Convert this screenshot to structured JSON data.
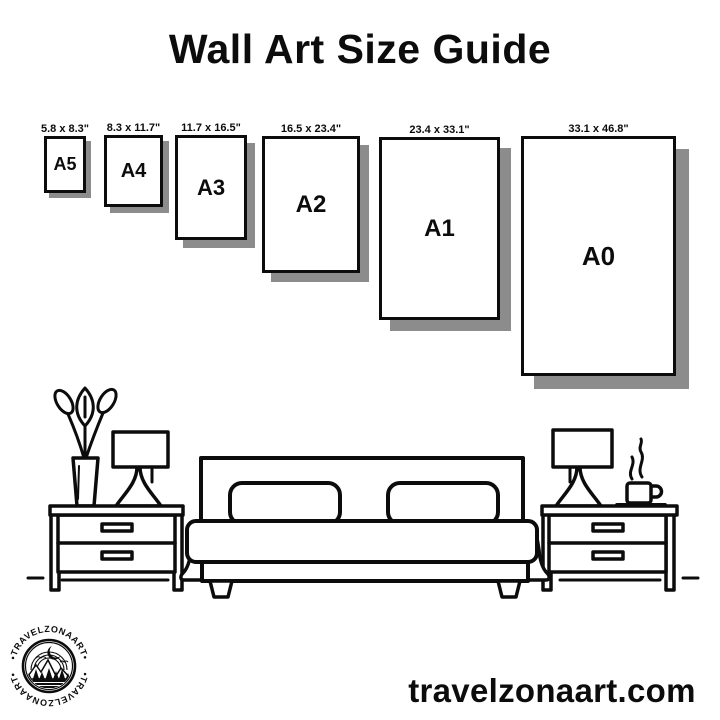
{
  "page": {
    "title": "Wall Art Size Guide",
    "website_text": "travelzonaart.com"
  },
  "colors": {
    "ink": "#0c0c0c",
    "shadow": "#8c8c8c",
    "background": "#ffffff"
  },
  "size_guide": {
    "sizes": [
      {
        "code": "A5",
        "label": "5.8 x 8.3\"",
        "width_in": 5.8,
        "height_in": 8.3
      },
      {
        "code": "A4",
        "label": "8.3 x 11.7\"",
        "width_in": 8.3,
        "height_in": 11.7
      },
      {
        "code": "A3",
        "label": "11.7 x 16.5\"",
        "width_in": 11.7,
        "height_in": 16.5
      },
      {
        "code": "A2",
        "label": "16.5 x 23.4\"",
        "width_in": 16.5,
        "height_in": 23.4
      },
      {
        "code": "A1",
        "label": "23.4 x 33.1\"",
        "width_in": 23.4,
        "height_in": 33.1
      },
      {
        "code": "A0",
        "label": "33.1 x 46.8\"",
        "width_in": 33.1,
        "height_in": 46.8
      }
    ]
  },
  "brand": {
    "badge_arc_text": "•TRAVELZONAART•"
  },
  "illustration": {
    "scene": "bedroom",
    "elements": [
      "potted-plant",
      "table-lamp",
      "nightstand",
      "double-bed-with-two-pillows",
      "nightstand",
      "table-lamp",
      "steaming-coffee-cup"
    ]
  }
}
